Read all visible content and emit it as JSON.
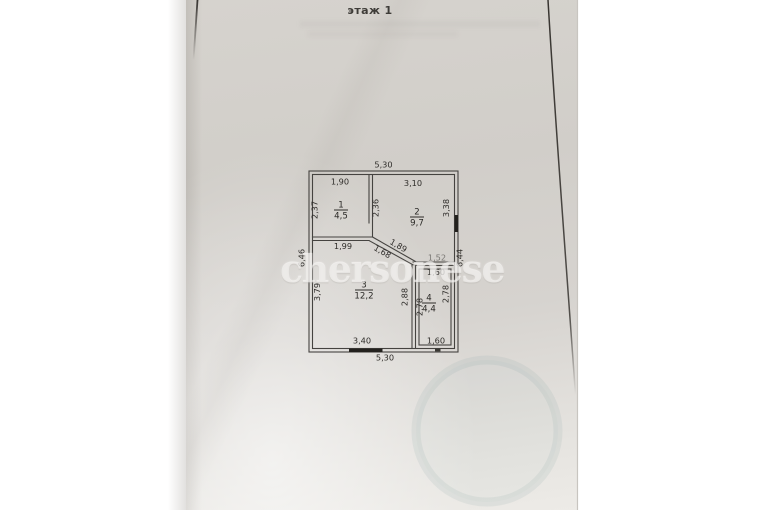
{
  "title": "этаж 1",
  "watermark": "chersonese",
  "colors": {
    "paper": "#d4d1cc",
    "ink": "#2f2d2a",
    "wall_line": "#454340",
    "door_fill": "#23211e",
    "watermark": "#f5f4f1",
    "stamp": "#7d9ba0"
  },
  "plan": {
    "outer": {
      "top": "5,30",
      "bottom": "5,30",
      "left": "6,46",
      "right": "6,44"
    },
    "rooms": [
      {
        "number": "1",
        "area": "4,5",
        "top": "1,90",
        "left": "2,37",
        "right": "2,36"
      },
      {
        "number": "2",
        "area": "9,7",
        "top": "3,10",
        "right": "3,38"
      },
      {
        "number": "3",
        "area": "12,2",
        "top": "1,99",
        "left": "3,79",
        "right": "2,88",
        "bottom": "3,40"
      },
      {
        "number": "4",
        "area": "4,4",
        "top_outer": "1,52",
        "top": "1,60",
        "left": "2,78",
        "right": "2,78",
        "bottom": "1,60"
      }
    ],
    "diagonal": {
      "outer": "1,89",
      "inner": "1,68"
    }
  }
}
